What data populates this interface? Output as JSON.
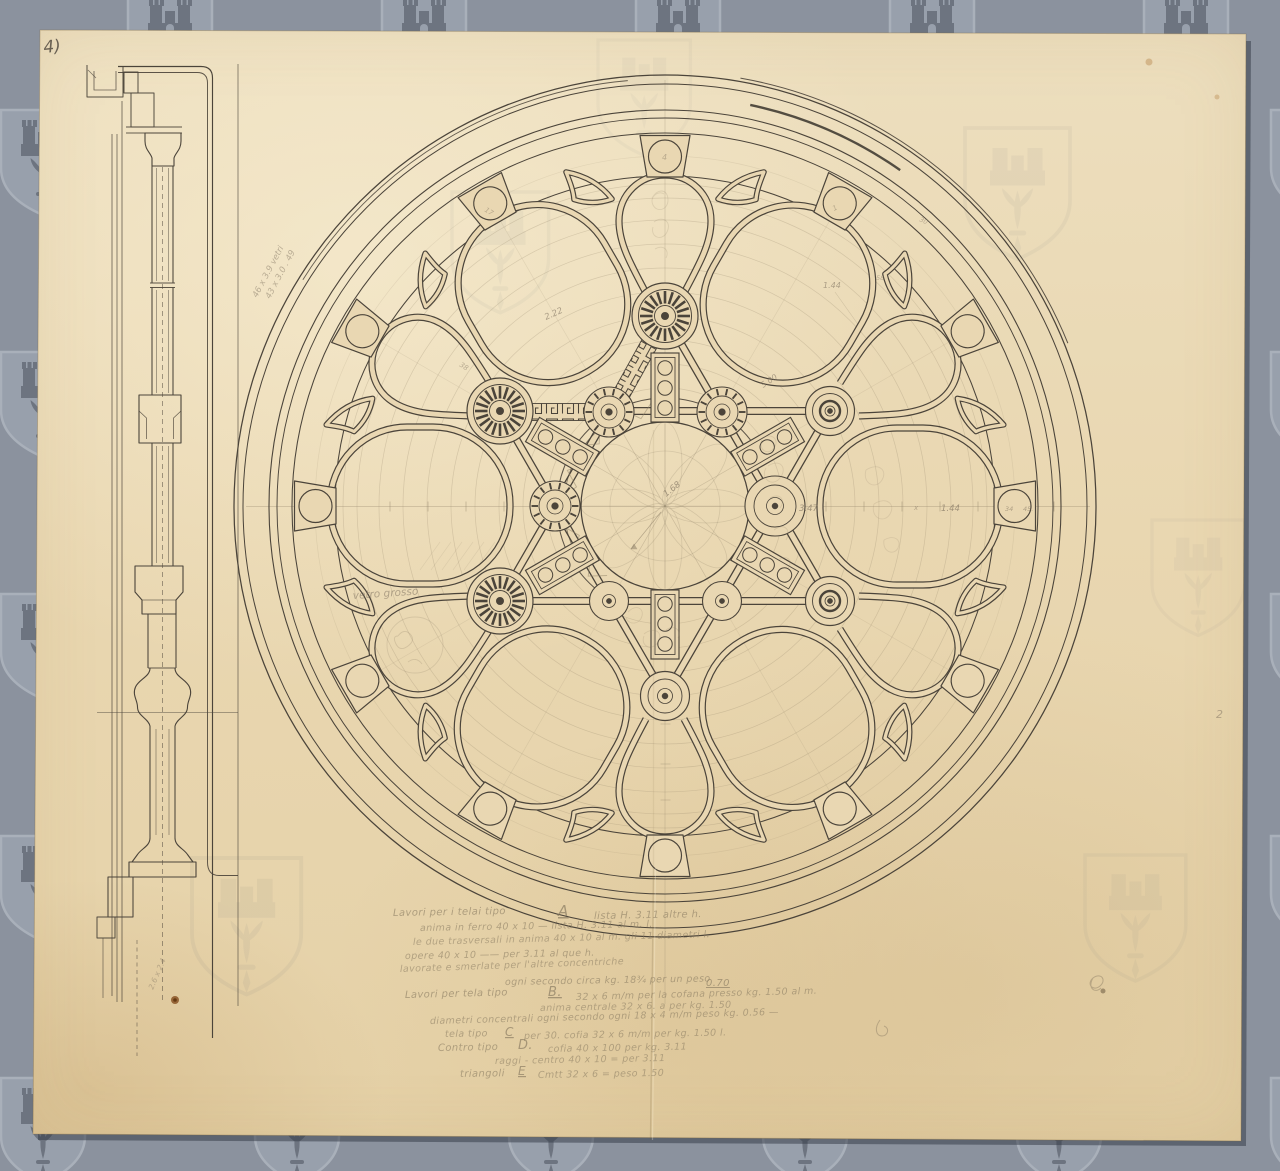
{
  "palette": {
    "background": "#8b929e",
    "watermark_dark": "#6d7480",
    "watermark_light": "#a9b0ba",
    "watermark_fill": "#98a0ac",
    "paper": "#e9d7b2",
    "ink": "#4b443a",
    "pencil": "#8f8168"
  },
  "sheet": {
    "page_label": "4)"
  },
  "drawing": {
    "dims": {
      "d222": "2.22",
      "d500": "5.00",
      "d144_upper": "1.44",
      "d347": "3.47",
      "d144_axis": "1.44",
      "d34": "34",
      "d45": "45.",
      "d168": "1.68",
      "d38": "38",
      "d58": "58",
      "d30": "30",
      "x_mark": "x",
      "block_top": "4",
      "block_11": "17",
      "block_1": "1"
    },
    "margin_notes": {
      "corner_number": "2",
      "vetro": "vetro grosso",
      "scribble1": "46 x 3.9 vetri",
      "scribble2": "43 x 3.0 . 49",
      "scribble3": "2.6 x 2.4"
    },
    "notes": {
      "l1a": "Lavori per i telai tipo",
      "l1t": "A",
      "l1b": "lista H. 3.11 altre h.",
      "l2": "anima in ferro  40 x 10  —  lista H. 3.11 al m. l.",
      "l3": "le due trasversali in anima 40 x 10 al m. gli 11 diametri l.",
      "l4": "opere  40 x 10  ——  per  3.11 al que h.",
      "l5": "lavorate e smerlate per l'altre concentriche",
      "l6a": "ogni secondo circa kg. 18¾ per un peso",
      "l6b": "0.70",
      "l7a": "Lavori per  tela  tipo",
      "l7t": "B.",
      "l7b": "32 x 6 m/m per la cofana presso kg. 1.50 al m.",
      "l8": "anima centrale 32 x 6. a per kg. 1.50",
      "l9": "diametri concentrali ogni secondo ogni  18 x 4 m/m  peso kg. 0.56 —",
      "l10a": "tela  tipo",
      "l10t": "C",
      "l10b": "per 30. cofia  32 x 6 m/m  per kg. 1.50 l.",
      "l11a": "Contro  tipo",
      "l11t": "D.",
      "l11b": "cofia  40 x 100 per kg. 3.11",
      "l12": "raggi - centro 40 x 10 = per  3.11",
      "l13a": "triangoli",
      "l13t": "E",
      "l13b": "Cmtt 32 x 6 = peso 1.50"
    }
  }
}
